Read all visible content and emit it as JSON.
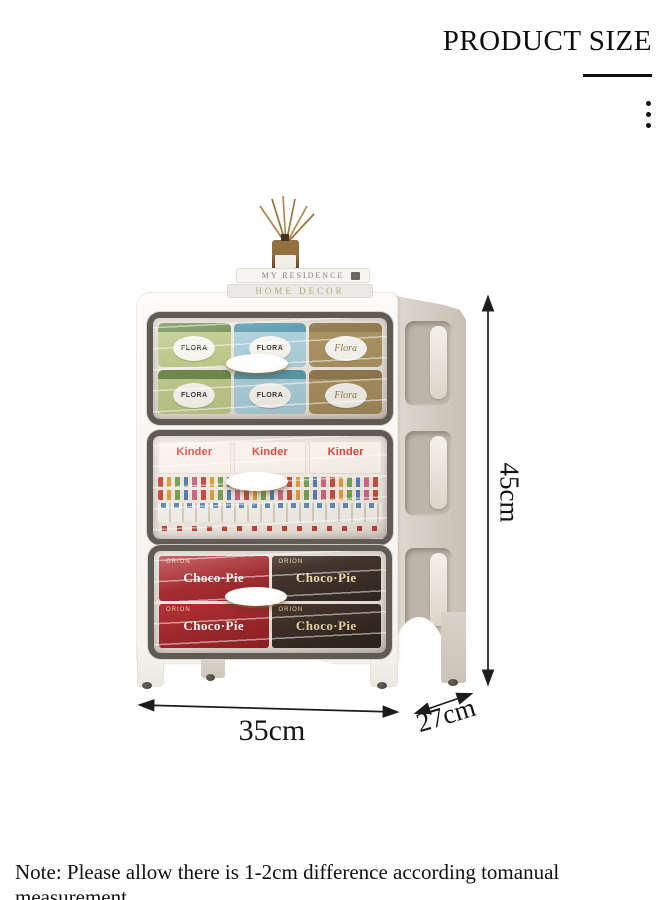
{
  "header": {
    "title": "PRODUCT SIZE"
  },
  "menu": {
    "icon": "vertical-ellipsis-icon",
    "dots": 3
  },
  "dimensions": {
    "height_label": "45cm",
    "width_label": "35cm",
    "depth_label": "27cm"
  },
  "product": {
    "decor": {
      "book_top_title": "MY RESIDENCE",
      "book_bottom_title": "HOME DECOR"
    },
    "tiers": [
      {
        "brand": "FLORA",
        "brand_script": "Flora"
      },
      {
        "brand": "Kinder"
      },
      {
        "brand": "Choco·Pie",
        "maker": "ORION"
      }
    ]
  },
  "note": {
    "text": "Note: Please allow there is 1-2cm difference according tomanual measurement"
  },
  "colors": {
    "background": "#ffffff",
    "annotation": "#141414",
    "cabinet_front": "#f7f5f1",
    "cabinet_side": "#d5cec4",
    "door_frame": "#46403a",
    "kinder_red": "#e03128",
    "chocopie_red": "#9e1c22",
    "chocopie_dark": "#33251f",
    "flora_green": "#b9c583",
    "flora_blue": "#a6cbd8",
    "flora_gold": "#a28a57"
  }
}
